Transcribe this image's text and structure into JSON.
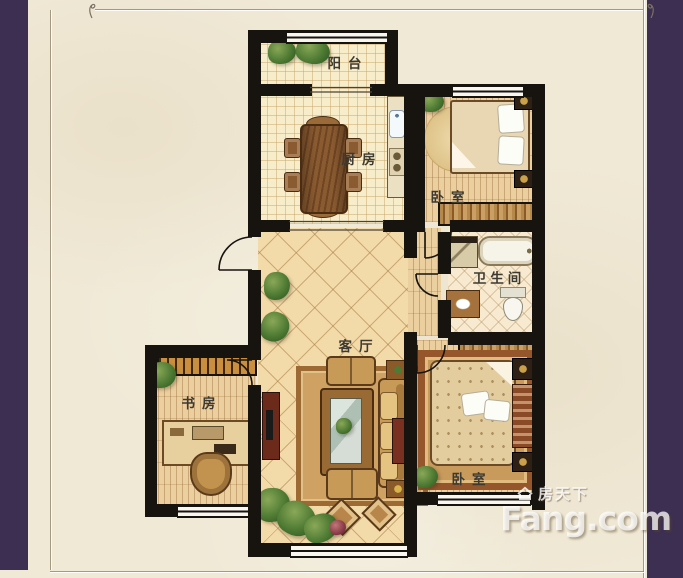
{
  "palette": {
    "frame_purple": "#3c2f52",
    "paper_cream": "#f0e9d6",
    "wall_black": "#17130f",
    "floor_tile": "#f8edcb",
    "floor_wood": "#eccf9f",
    "floor_living": "#f3daa9",
    "furniture_wood": "#8a5a28",
    "plant_green": "#4e7a33",
    "watermark_white": "rgba(255,255,255,0.75)"
  },
  "rooms": [
    {
      "name": "balcony",
      "label": "阳台"
    },
    {
      "name": "kitchen",
      "label": "厨房"
    },
    {
      "name": "bedroom-north",
      "label": "卧室"
    },
    {
      "name": "bathroom",
      "label": "卫生间"
    },
    {
      "name": "living-room",
      "label": "客厅"
    },
    {
      "name": "study",
      "label": "书房"
    },
    {
      "name": "bedroom-south",
      "label": "卧室"
    }
  ],
  "watermark": {
    "site_name_cn": "房天下",
    "site_name_en": "Fang.com",
    "icon": "house-icon"
  }
}
